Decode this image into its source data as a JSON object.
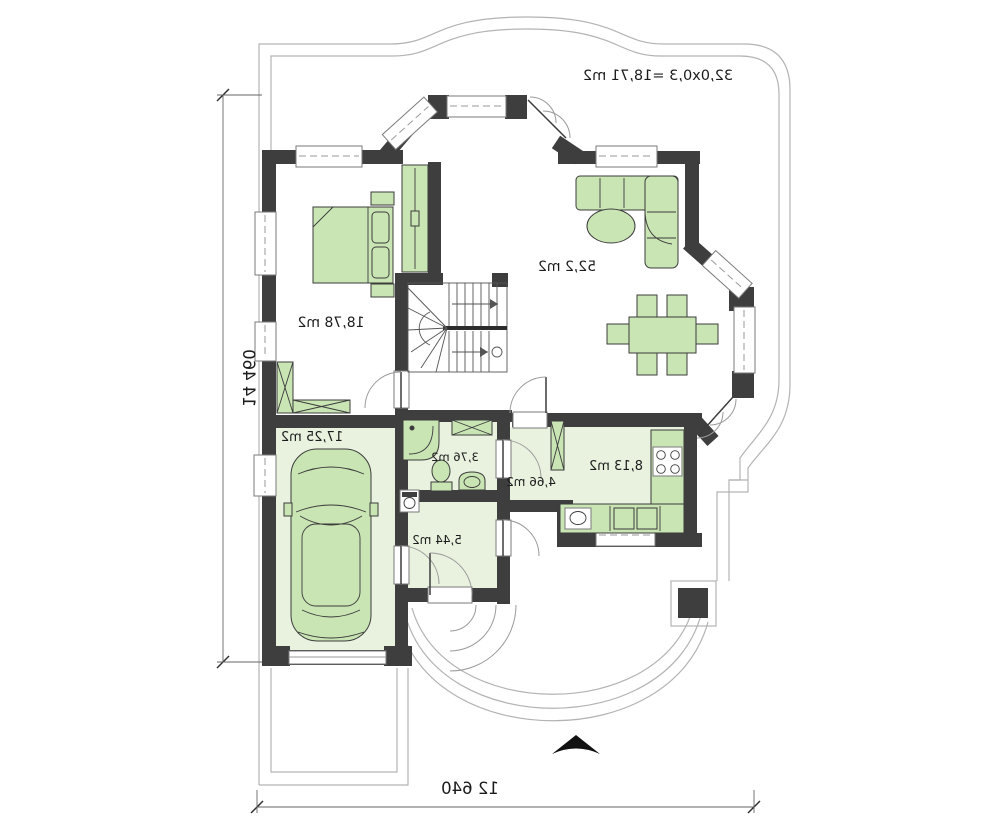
{
  "plan": {
    "annotation": "32,0x0,3 =18,71 m2",
    "rooms": [
      {
        "id": "living-room",
        "area_label": "52,2 m2"
      },
      {
        "id": "bedroom",
        "area_label": "18,78 m2"
      },
      {
        "id": "garage",
        "area_label": "17,25 m2"
      },
      {
        "id": "bathroom",
        "area_label": "3,76 m2"
      },
      {
        "id": "hall",
        "area_label": "4,66 m2"
      },
      {
        "id": "kitchen",
        "area_label": "8,13 m2"
      },
      {
        "id": "entry",
        "area_label": "5,44 m2"
      }
    ],
    "dimensions": {
      "width_label": "12 640",
      "height_label": "14 460"
    },
    "colors": {
      "wall": "#3e3e3e",
      "furniture": "#c9e5b4",
      "floor": "#e9f2df",
      "outline": "#b3b3b3"
    },
    "note": "plan is rendered mirror-imaged (all lettering reversed)"
  }
}
